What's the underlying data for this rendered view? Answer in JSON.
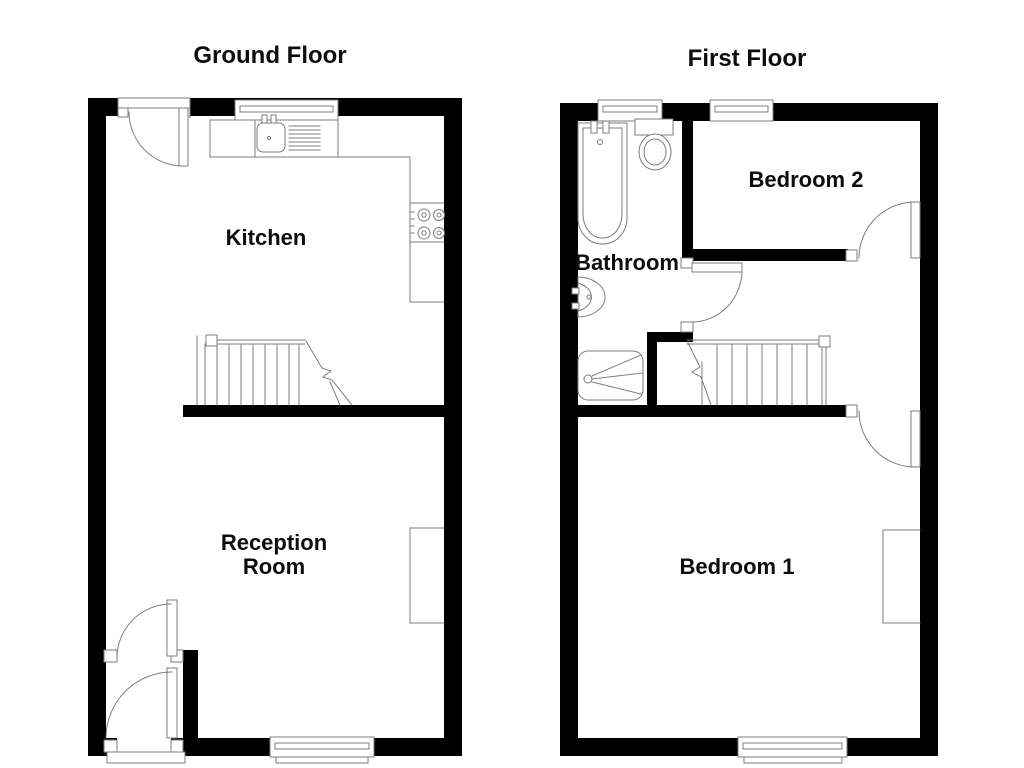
{
  "canvas": {
    "width": 1024,
    "height": 768,
    "background": "#ffffff"
  },
  "colors": {
    "wall": "#000000",
    "fixture_line": "#7d7d7d",
    "text": "#0d0d0d",
    "floor_fill": "#ffffff"
  },
  "floors": [
    {
      "title": "Ground Floor",
      "rooms": [
        {
          "label": "Kitchen"
        },
        {
          "label_lines": [
            "Reception",
            "Room"
          ]
        }
      ],
      "fixtures": [
        "entrance-door",
        "kitchen-window",
        "sink-drainer-unit",
        "worktop",
        "hob",
        "staircase",
        "chimney-breast",
        "rear-window",
        "vestibule-inner-door",
        "front-door",
        "front-door-threshold"
      ]
    },
    {
      "title": "First Floor",
      "rooms": [
        {
          "label": "Bathroom"
        },
        {
          "label": "Bedroom 2"
        },
        {
          "label": "Bedroom 1"
        }
      ],
      "fixtures": [
        "bath",
        "toilet",
        "basin",
        "shower",
        "staircase",
        "bathroom-door",
        "bedroom2-door",
        "bedroom1-door",
        "front-windows",
        "rear-window",
        "chimney-breast"
      ]
    }
  ]
}
